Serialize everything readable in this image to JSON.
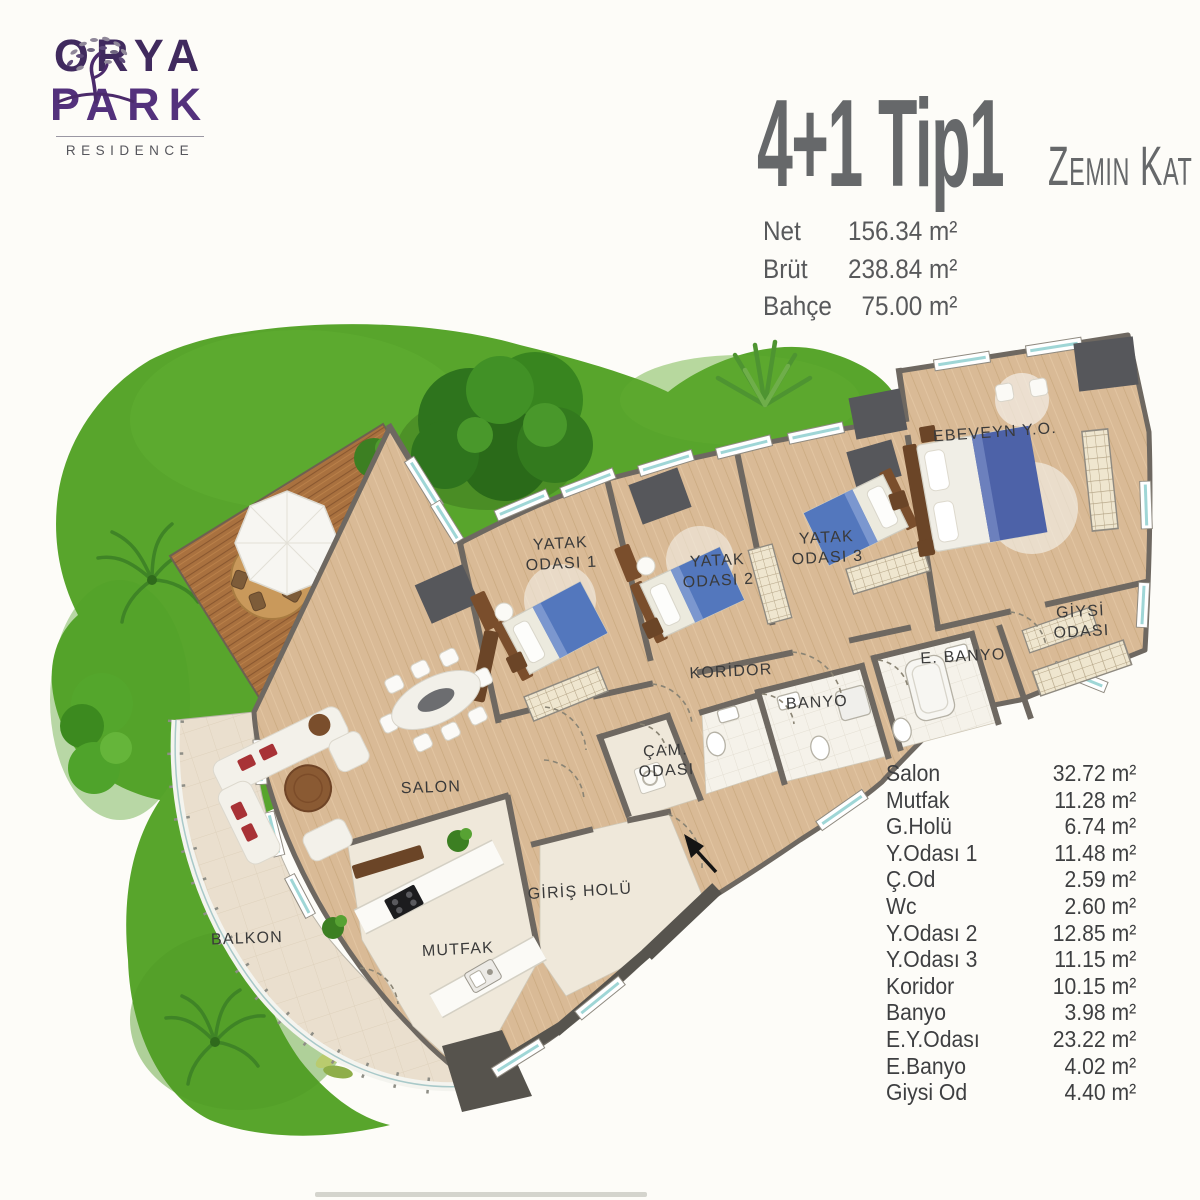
{
  "logo": {
    "icon": "tree-icon",
    "line1": "ORYA",
    "line2": "PARK",
    "subtitle": "RESIDENCE"
  },
  "header": {
    "title": "4+1 Tip1",
    "floor_label": "Zemin Kat",
    "stats": [
      {
        "label": "Net",
        "value": "156.34 m²"
      },
      {
        "label": "Brüt",
        "value": "238.84 m²"
      },
      {
        "label": "Bahçe",
        "value": "75.00 m²"
      }
    ]
  },
  "plan": {
    "labels": [
      {
        "id": "ebeveyn",
        "line1": "EBEVEYN Y.O.",
        "line2": ""
      },
      {
        "id": "yatak1",
        "line1": "YATAK",
        "line2": "ODASI 1"
      },
      {
        "id": "yatak2",
        "line1": "YATAK",
        "line2": "ODASI 2"
      },
      {
        "id": "yatak3",
        "line1": "YATAK",
        "line2": "ODASI 3"
      },
      {
        "id": "giysi",
        "line1": "GİYSİ",
        "line2": "ODASI"
      },
      {
        "id": "ebanyo",
        "line1": "E. BANYO",
        "line2": ""
      },
      {
        "id": "banyo",
        "line1": "BANYO",
        "line2": ""
      },
      {
        "id": "koridor",
        "line1": "KORİDOR",
        "line2": ""
      },
      {
        "id": "cam",
        "line1": "ÇAM.",
        "line2": "ODASI"
      },
      {
        "id": "salon",
        "line1": "SALON",
        "line2": ""
      },
      {
        "id": "giris",
        "line1": "GİRİŞ HOLÜ",
        "line2": ""
      },
      {
        "id": "mutfak",
        "line1": "MUTFAK",
        "line2": ""
      },
      {
        "id": "balkon",
        "line1": "BALKON",
        "line2": ""
      }
    ]
  },
  "rooms": [
    {
      "name": "Salon",
      "area": "32.72 m²"
    },
    {
      "name": "Mutfak",
      "area": "11.28 m²"
    },
    {
      "name": "G.Holü",
      "area": "6.74 m²"
    },
    {
      "name": "Y.Odası 1",
      "area": "11.48 m²"
    },
    {
      "name": "Ç.Od",
      "area": "2.59 m²"
    },
    {
      "name": "Wc",
      "area": "2.60 m²"
    },
    {
      "name": "Y.Odası 2",
      "area": "12.85 m²"
    },
    {
      "name": "Y.Odası 3",
      "area": "11.15 m²"
    },
    {
      "name": "Koridor",
      "area": "10.15 m²"
    },
    {
      "name": "Banyo",
      "area": "3.98 m²"
    },
    {
      "name": "E.Y.Odası",
      "area": "23.22 m²"
    },
    {
      "name": "E.Banyo",
      "area": "4.02 m²"
    },
    {
      "name": "Giysi Od",
      "area": "4.40 m²"
    }
  ],
  "colors": {
    "logo_purple": "#472a66",
    "title_gray": "#66686a",
    "grass": "#58a52c",
    "deck_wood": "#a9713f",
    "floor_wood": "#d9ba96",
    "wall_gray": "#6e6861",
    "bed_blue": "#5377bd",
    "label_text": "#3a3a3a"
  }
}
